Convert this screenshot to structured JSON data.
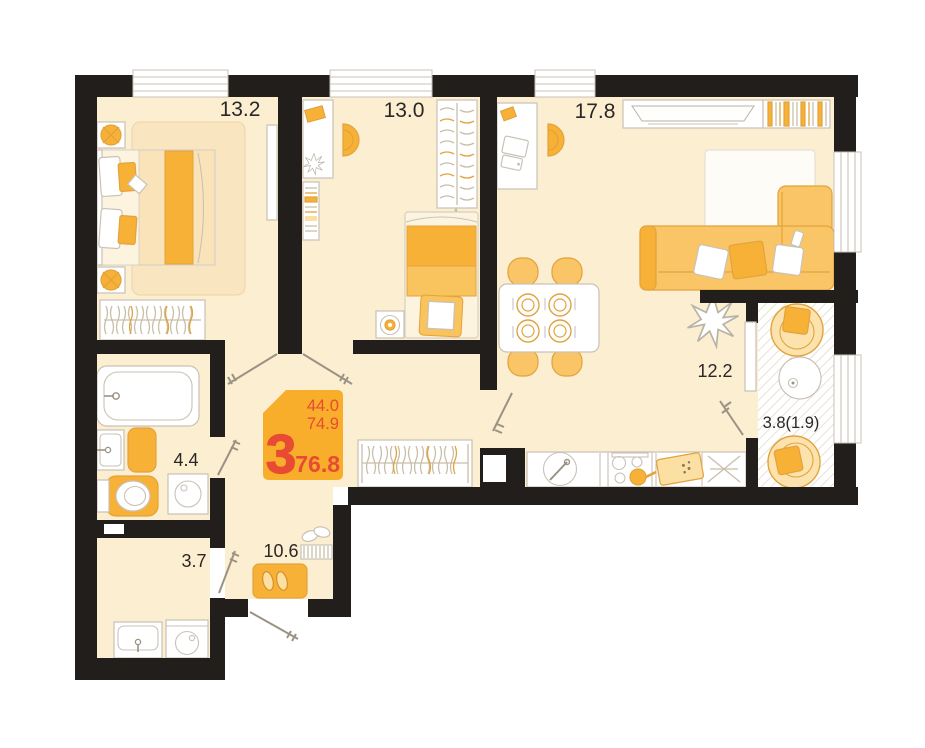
{
  "plan": {
    "badge": {
      "rooms_count": "3",
      "area_line1": "44.0",
      "area_line2": "74.9",
      "area_total": "76.8"
    },
    "rooms": {
      "bedroom": {
        "area": "13.2"
      },
      "child_room": {
        "area": "13.0"
      },
      "living_room": {
        "area": "17.8"
      },
      "kitchen": {
        "area": "12.2"
      },
      "bathroom": {
        "area": "4.4"
      },
      "wc": {
        "area": "3.7"
      },
      "hallway": {
        "area": "10.6"
      },
      "balcony": {
        "area": "3.8(1.9)"
      }
    }
  },
  "colors": {
    "wall": "#211E1B",
    "floor": "#FBEED1",
    "accent": "#F8B137",
    "accent_mid": "#F9C566",
    "accent_light": "#FBDFA3",
    "accent_soft": "#FCE9C4",
    "accent_line": "#E2A33C",
    "badge": "#F9AE2B",
    "red": "#E84A33",
    "outline": "#C9C2B6",
    "line": "#9A9283",
    "hatch": "#E2DACC",
    "text": "#2B2724"
  }
}
